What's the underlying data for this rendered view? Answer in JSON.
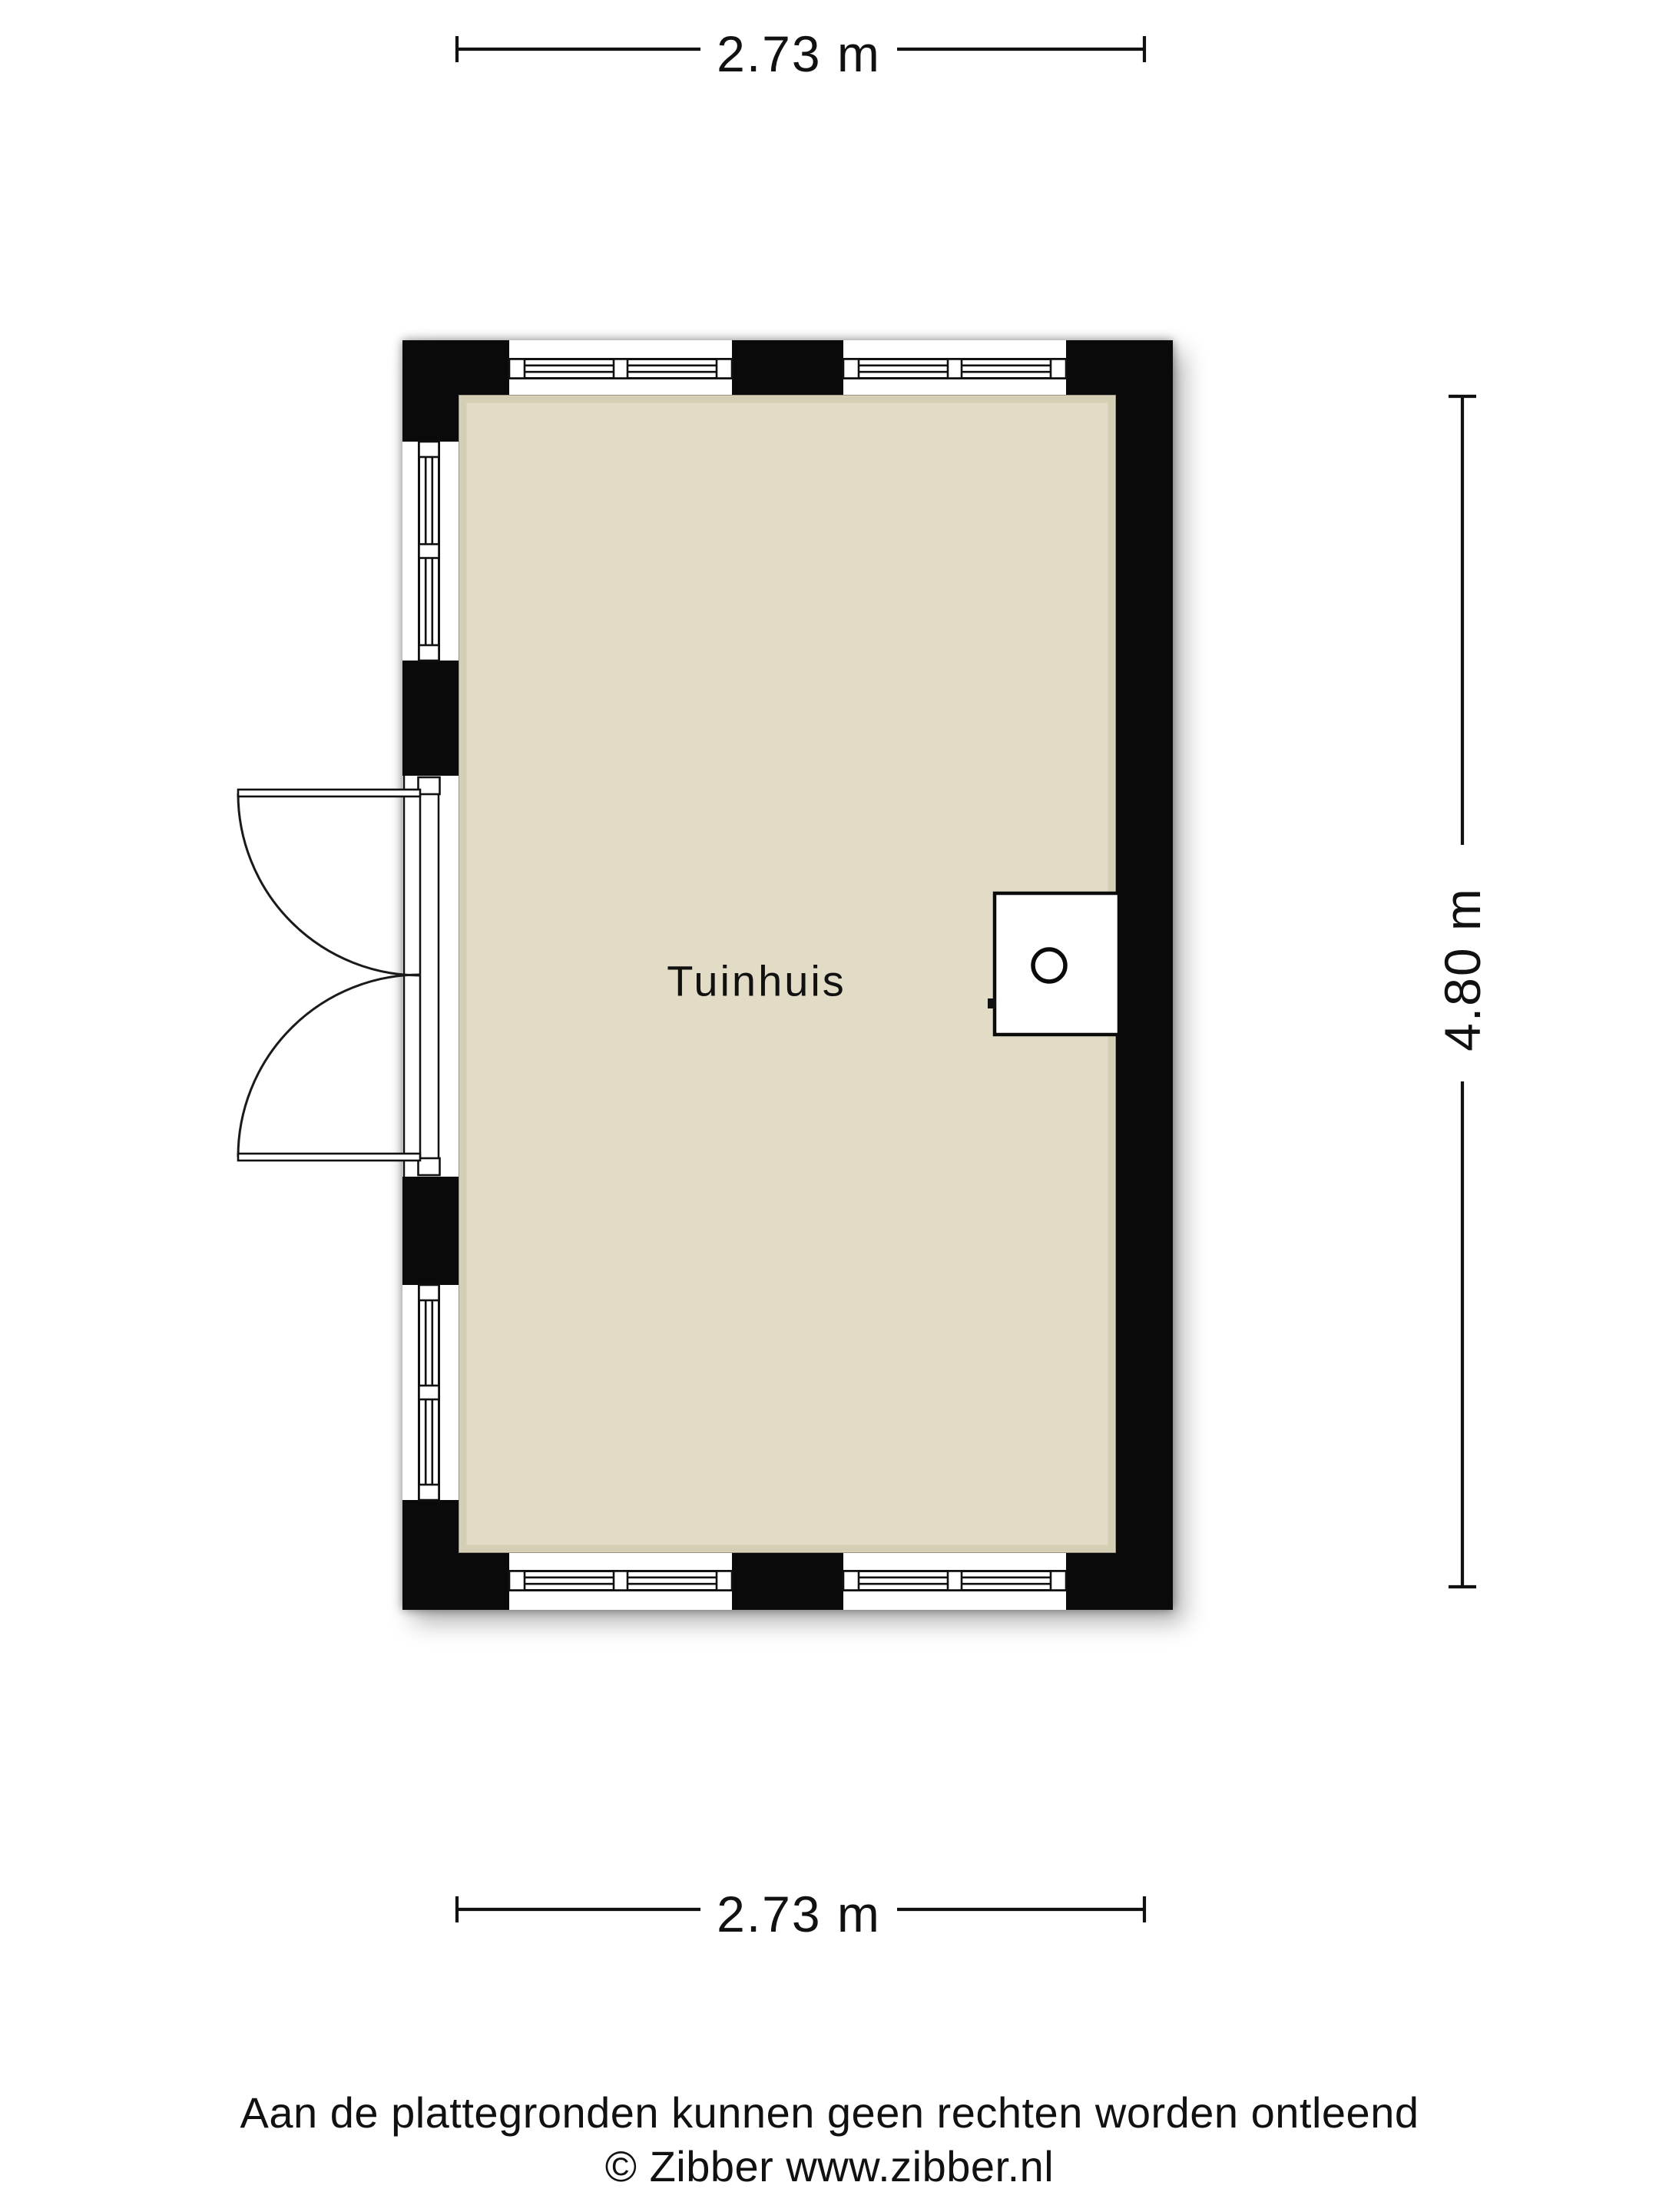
{
  "room": {
    "label": "Tuinhuis"
  },
  "dimensions": {
    "top": "2.73 m",
    "right": "4.80 m",
    "bottom": "2.73 m"
  },
  "footer": {
    "disclaimer": "Aan de plattegronden kunnen geen rechten worden ontleend",
    "copyright": "© Zibber www.zibber.nl"
  },
  "colors": {
    "wall": "#0a0a0a",
    "floor": "#e2dcc6",
    "floor_edge": "#c9c2a8",
    "line": "#111111",
    "background": "#ffffff"
  }
}
